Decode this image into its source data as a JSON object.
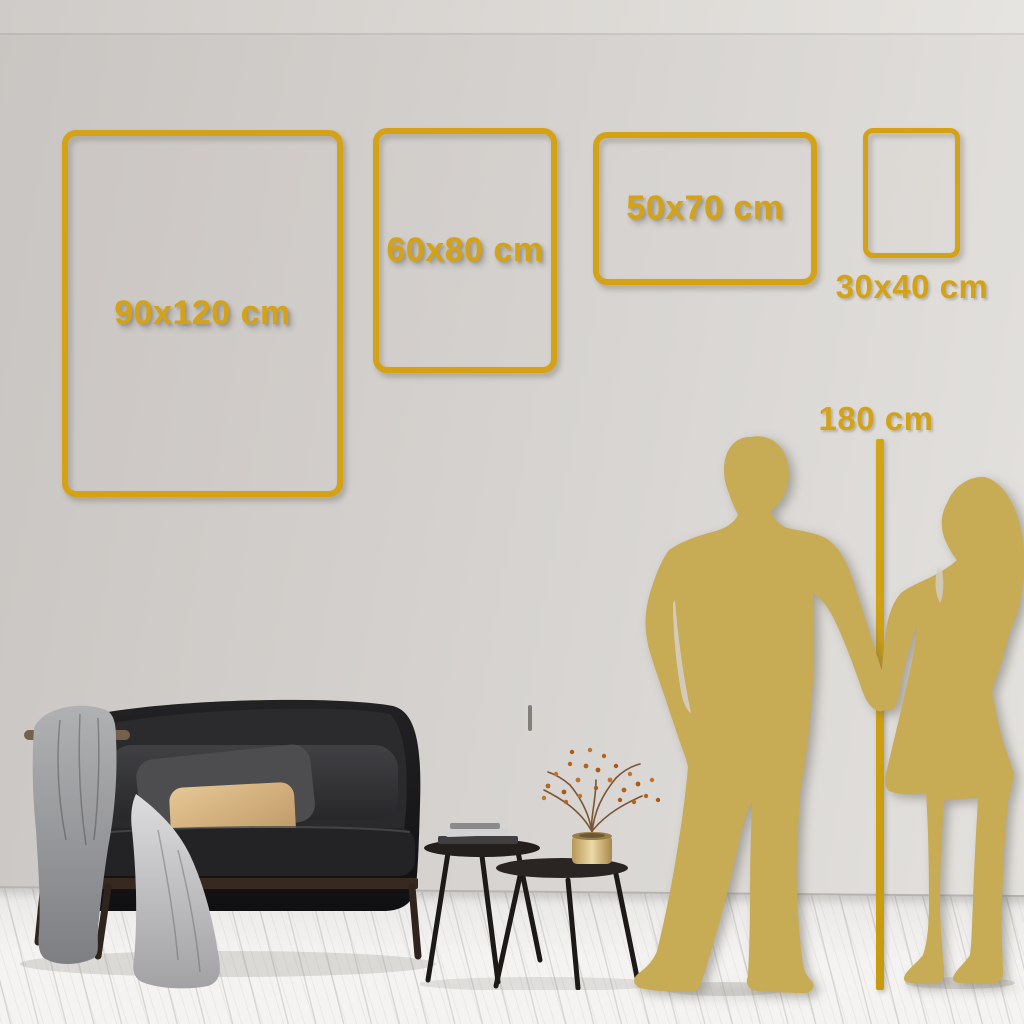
{
  "frames": [
    {
      "label": "90x120 cm",
      "width_cm": 90,
      "height_cm": 120,
      "orientation": "portrait"
    },
    {
      "label": "60x80 cm",
      "width_cm": 60,
      "height_cm": 80,
      "orientation": "portrait"
    },
    {
      "label": "50x70 cm",
      "width_cm": 50,
      "height_cm": 70,
      "orientation": "landscape"
    },
    {
      "label": "30x40 cm",
      "width_cm": 30,
      "height_cm": 40,
      "orientation": "portrait",
      "label_position": "below-frame"
    }
  ],
  "height_reference": {
    "label": "180 cm",
    "value_cm": 180,
    "shown_as": "couple-silhouette-with-vertical-line"
  },
  "colors": {
    "accent_gold": "#D4A214",
    "silhouette_gold": "#C7AB55",
    "wall_left": "#C9C5C2",
    "wall_right": "#E4E2DE",
    "floor": "#F4F3F1"
  }
}
